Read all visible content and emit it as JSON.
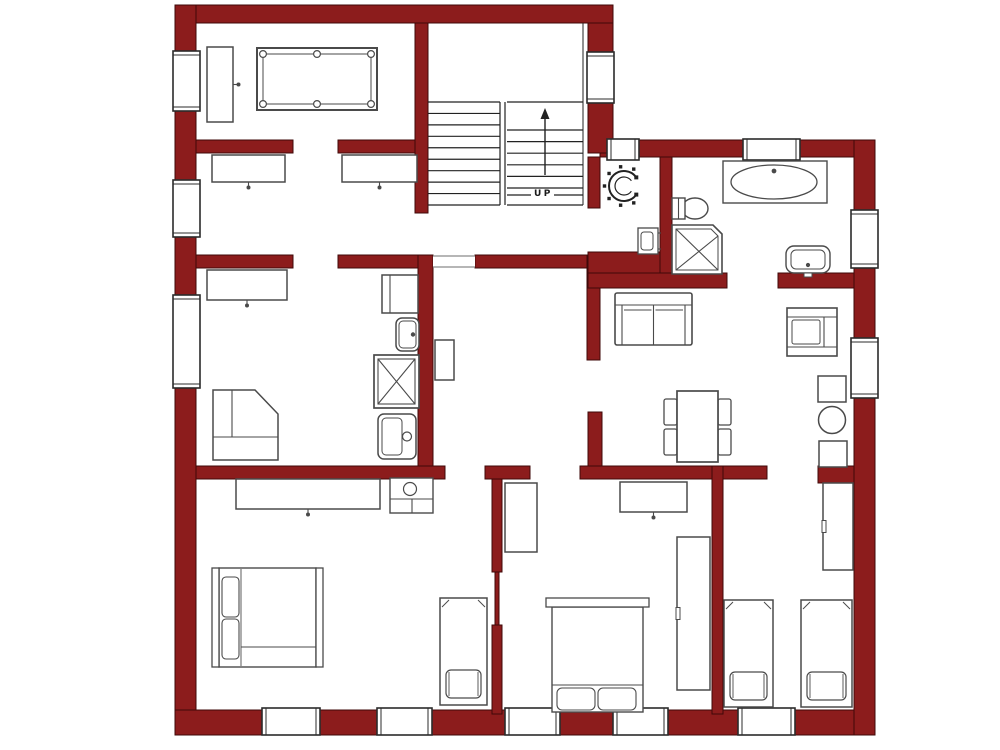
{
  "meta": {
    "kind": "apartment-floor-plan",
    "canvas": {
      "width": 1000,
      "height": 750
    }
  },
  "colors": {
    "background": "#ffffff",
    "wall_fill": "#8C1C1C",
    "wall_stroke": "#3F0909",
    "line": "#4a4a4a",
    "line_dark": "#222222",
    "window_stroke": "#2b2b2b",
    "fill_white": "#ffffff"
  },
  "stairs": {
    "label": "UP",
    "label_x": 534,
    "label_y": 196,
    "left_flight": {
      "x1": 428,
      "x2": 500,
      "y1": 102,
      "y2": 205,
      "steps": 9
    },
    "right_flight": {
      "x1": 507,
      "x2": 583,
      "y1": 130,
      "y2": 188,
      "steps": 5
    },
    "right_top_y": 102,
    "right_bottom_y": 205,
    "partial_treads": [
      {
        "x1": 507,
        "x2": 531,
        "y": 195
      },
      {
        "x1": 554,
        "x2": 583,
        "y": 195
      }
    ],
    "divider_x": [
      500,
      505
    ],
    "divider_y1": 102,
    "divider_y2": 205,
    "edge_line": {
      "x": 583,
      "y1": 23,
      "y2": 205
    },
    "arrow": {
      "x": 545,
      "y1": 175,
      "y2": 119,
      "head": [
        [
          545,
          108
        ],
        [
          540.5,
          119
        ],
        [
          549.5,
          119
        ]
      ]
    }
  },
  "walls": [
    {
      "name": "wall-outer-top",
      "x": 175,
      "y": 5,
      "w": 438,
      "h": 18
    },
    {
      "name": "wall-outer-left",
      "x": 175,
      "y": 5,
      "w": 21,
      "h": 730
    },
    {
      "name": "wall-outer-bottom",
      "x": 175,
      "y": 710,
      "w": 700,
      "h": 25
    },
    {
      "name": "wall-outer-top-right",
      "x": 600,
      "y": 140,
      "w": 275,
      "h": 17
    },
    {
      "name": "wall-outer-right",
      "x": 854,
      "y": 140,
      "w": 21,
      "h": 595
    },
    {
      "name": "wall-stairwell-right",
      "x": 588,
      "y": 23,
      "w": 25,
      "h": 130
    },
    {
      "name": "wall-room1-bottom-left",
      "x": 196,
      "y": 140,
      "w": 97,
      "h": 13
    },
    {
      "name": "wall-room1-bottom-right",
      "x": 338,
      "y": 140,
      "w": 90,
      "h": 13
    },
    {
      "name": "wall-stairwell-left",
      "x": 415,
      "y": 23,
      "w": 13,
      "h": 190
    },
    {
      "name": "wall-room2-bottom-left",
      "x": 196,
      "y": 255,
      "w": 97,
      "h": 13
    },
    {
      "name": "wall-room2-bottom-right",
      "x": 338,
      "y": 255,
      "w": 90,
      "h": 13
    },
    {
      "name": "wall-kitchen-right",
      "x": 418,
      "y": 255,
      "w": 15,
      "h": 223
    },
    {
      "name": "wall-hall-top",
      "x": 475,
      "y": 255,
      "w": 112,
      "h": 13
    },
    {
      "name": "wall-living-left-upper",
      "x": 587,
      "y": 255,
      "w": 13,
      "h": 105
    },
    {
      "name": "wall-living-left-lower",
      "x": 588,
      "y": 412,
      "w": 14,
      "h": 60
    },
    {
      "name": "wall-wc-left",
      "x": 588,
      "y": 157,
      "w": 12,
      "h": 51
    },
    {
      "name": "wall-wc-bottom",
      "x": 588,
      "y": 252,
      "w": 72,
      "h": 21
    },
    {
      "name": "wall-bath-bottom-left",
      "x": 588,
      "y": 273,
      "w": 139,
      "h": 15
    },
    {
      "name": "wall-bath-bottom-right",
      "x": 778,
      "y": 273,
      "w": 76,
      "h": 15
    },
    {
      "name": "wall-wc-bath-divider",
      "x": 660,
      "y": 157,
      "w": 12,
      "h": 116
    },
    {
      "name": "wall-bedrooms-top-a",
      "x": 196,
      "y": 466,
      "w": 249,
      "h": 13
    },
    {
      "name": "wall-bedrooms-top-b",
      "x": 485,
      "y": 466,
      "w": 45,
      "h": 13
    },
    {
      "name": "wall-bedrooms-top-c",
      "x": 580,
      "y": 466,
      "w": 187,
      "h": 13
    },
    {
      "name": "wall-bedrooms-top-d",
      "x": 818,
      "y": 466,
      "w": 36,
      "h": 17
    },
    {
      "name": "wall-bed1-bed2-upper",
      "x": 492,
      "y": 479,
      "w": 10,
      "h": 93
    },
    {
      "name": "wall-bed1-bed2-door",
      "x": 495,
      "y": 572,
      "w": 4,
      "h": 53
    },
    {
      "name": "wall-bed1-bed2-lower",
      "x": 492,
      "y": 625,
      "w": 10,
      "h": 89
    },
    {
      "name": "wall-bed2-bed3",
      "x": 712,
      "y": 466,
      "w": 11,
      "h": 248
    }
  ],
  "windows": [
    {
      "x": 173,
      "y": 51,
      "w": 27,
      "h": 60,
      "o": "v"
    },
    {
      "x": 173,
      "y": 180,
      "w": 27,
      "h": 57,
      "o": "v"
    },
    {
      "x": 173,
      "y": 295,
      "w": 27,
      "h": 93,
      "o": "v"
    },
    {
      "x": 587,
      "y": 52,
      "w": 27,
      "h": 51,
      "o": "v"
    },
    {
      "x": 607,
      "y": 139,
      "w": 32,
      "h": 21,
      "o": "h"
    },
    {
      "x": 743,
      "y": 139,
      "w": 57,
      "h": 21,
      "o": "h"
    },
    {
      "x": 851,
      "y": 210,
      "w": 27,
      "h": 58,
      "o": "v"
    },
    {
      "x": 851,
      "y": 338,
      "w": 27,
      "h": 60,
      "o": "v"
    },
    {
      "x": 262,
      "y": 708,
      "w": 58,
      "h": 27,
      "o": "h"
    },
    {
      "x": 377,
      "y": 708,
      "w": 55,
      "h": 27,
      "o": "h"
    },
    {
      "x": 505,
      "y": 708,
      "w": 55,
      "h": 27,
      "o": "h"
    },
    {
      "x": 613,
      "y": 708,
      "w": 55,
      "h": 27,
      "o": "h"
    },
    {
      "x": 738,
      "y": 708,
      "w": 57,
      "h": 27,
      "o": "h"
    }
  ],
  "openings": [
    {
      "name": "door-opening-hall",
      "x": 433,
      "y": 256,
      "w": 42,
      "h": 11
    }
  ],
  "furniture": [
    {
      "type": "pool-table",
      "name": "pool-table",
      "x": 257,
      "y": 48,
      "w": 120,
      "h": 62
    },
    {
      "type": "rect-knob",
      "name": "tall-cabinet",
      "x": 207,
      "y": 47,
      "w": 26,
      "h": 75,
      "knob": "right"
    },
    {
      "type": "rect-knob",
      "name": "sideboard",
      "x": 212,
      "y": 155,
      "w": 73,
      "h": 27,
      "knob": "bottom"
    },
    {
      "type": "rect-knob",
      "name": "sideboard",
      "x": 342,
      "y": 155,
      "w": 75,
      "h": 27,
      "knob": "bottom"
    },
    {
      "type": "rect-knob",
      "name": "sideboard",
      "x": 207,
      "y": 270,
      "w": 80,
      "h": 30,
      "knob": "bottom"
    },
    {
      "type": "corner-unit",
      "name": "kitchen-corner-counter",
      "x": 213,
      "y": 390,
      "w": 65,
      "h": 70,
      "cutx": 42,
      "cuty": 24,
      "innery": 47,
      "innerx": 19
    },
    {
      "type": "fridge",
      "name": "kitchen-cabinet",
      "x": 382,
      "y": 275,
      "w": 36,
      "h": 38
    },
    {
      "type": "sink",
      "name": "kitchen-sink-small",
      "x": 396,
      "y": 318,
      "w": 23,
      "h": 33
    },
    {
      "type": "stove",
      "name": "stove",
      "x": 374,
      "y": 355,
      "w": 45,
      "h": 53
    },
    {
      "type": "sink2",
      "name": "kitchen-sink",
      "x": 378,
      "y": 414,
      "w": 38,
      "h": 45
    },
    {
      "type": "rect",
      "name": "hall-shelf",
      "x": 435,
      "y": 340,
      "w": 19,
      "h": 40
    },
    {
      "type": "wc-toilet",
      "name": "wc-toilet",
      "cx": 624,
      "cy": 186,
      "r": 15
    },
    {
      "type": "wall-sink",
      "name": "wc-hand-basin",
      "x": 638,
      "y": 228,
      "w": 20,
      "h": 26
    },
    {
      "type": "toilet",
      "name": "bathroom-toilet",
      "x": 672,
      "y": 198,
      "w": 36,
      "h": 21
    },
    {
      "type": "shower",
      "name": "shower",
      "x": 672,
      "y": 225,
      "w": 50,
      "h": 49,
      "cut": 9
    },
    {
      "type": "bathtub",
      "name": "bathtub",
      "x": 723,
      "y": 161,
      "w": 104,
      "h": 42
    },
    {
      "type": "vanity-sink",
      "name": "bathroom-sink",
      "x": 786,
      "y": 246,
      "w": 44,
      "h": 27
    },
    {
      "type": "sofa",
      "name": "sofa",
      "x": 615,
      "y": 293,
      "w": 77,
      "h": 52
    },
    {
      "type": "armchair",
      "name": "armchair",
      "x": 787,
      "y": 308,
      "w": 50,
      "h": 48
    },
    {
      "type": "dining-set",
      "name": "dining-table",
      "x": 677,
      "y": 391,
      "w": 41,
      "h": 71
    },
    {
      "type": "rect",
      "name": "side-table",
      "x": 818,
      "y": 376,
      "w": 28,
      "h": 26
    },
    {
      "type": "circle-table",
      "name": "round-table",
      "cx": 832,
      "cy": 420,
      "r": 13.5
    },
    {
      "type": "rect",
      "name": "side-table",
      "x": 819,
      "y": 441,
      "w": 28,
      "h": 26
    },
    {
      "type": "rect-knob",
      "name": "dresser",
      "x": 236,
      "y": 479,
      "w": 144,
      "h": 30,
      "knob": "bottom"
    },
    {
      "type": "vanity",
      "name": "washbasin-cabinet",
      "x": 390,
      "y": 478,
      "w": 43,
      "h": 35
    },
    {
      "type": "double-bed-left",
      "name": "double-bed",
      "x": 212,
      "y": 568,
      "w": 111,
      "h": 99
    },
    {
      "type": "single-bed",
      "name": "single-bed",
      "x": 440,
      "y": 598,
      "w": 47,
      "h": 107
    },
    {
      "type": "rect",
      "name": "bedroom-cabinet",
      "x": 505,
      "y": 483,
      "w": 32,
      "h": 69
    },
    {
      "type": "rect-knob",
      "name": "dresser",
      "x": 620,
      "y": 482,
      "w": 67,
      "h": 30,
      "knob": "bottom"
    },
    {
      "type": "wardrobe",
      "name": "wardrobe",
      "x": 677,
      "y": 537,
      "w": 33,
      "h": 153
    },
    {
      "type": "double-bed-top",
      "name": "double-bed",
      "x": 546,
      "y": 598,
      "w": 103,
      "h": 114
    },
    {
      "type": "wardrobe",
      "name": "wardrobe",
      "x": 823,
      "y": 483,
      "w": 30,
      "h": 87
    },
    {
      "type": "single-bed",
      "name": "single-bed",
      "x": 724,
      "y": 600,
      "w": 49,
      "h": 107
    },
    {
      "type": "single-bed",
      "name": "single-bed",
      "x": 801,
      "y": 600,
      "w": 51,
      "h": 107
    }
  ]
}
